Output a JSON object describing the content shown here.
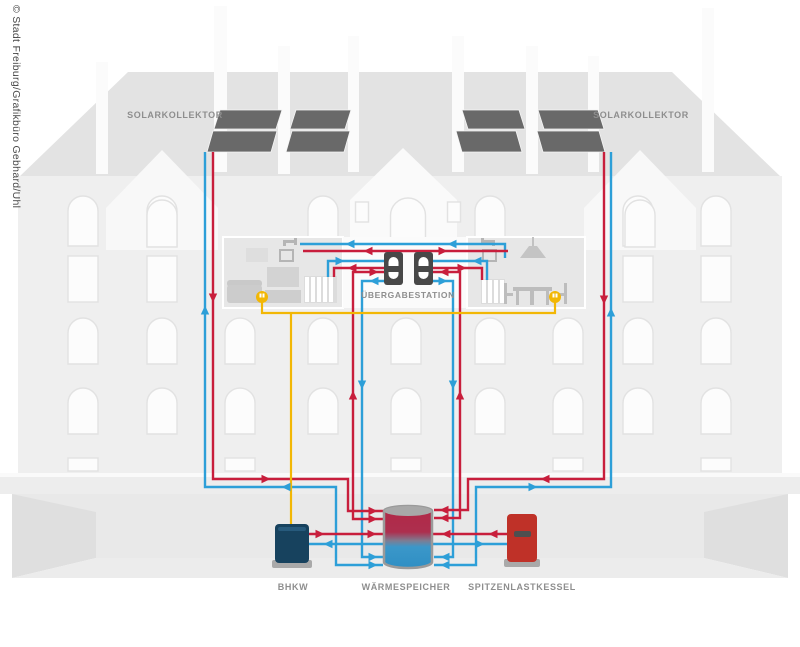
{
  "credit": "© Stadt Freiburg/Grafikbüro Gebhard/Uhl",
  "diagram": {
    "solar_collector_left": "SOLARKOLLEKTOR",
    "solar_collector_right": "SOLARKOLLEKTOR",
    "transfer_station": "ÜBERGABESTATION",
    "chp_unit": "BHKW",
    "heat_storage": "WÄRMESPEICHER",
    "peak_load_boiler": "SPITZENLASTKESSEL"
  },
  "colors": {
    "hot_pipe": "#c81e3c",
    "cold_pipe": "#2d9fd8",
    "power_line": "#f2b705",
    "solar_panel": "#696969",
    "chp_body": "#17425e",
    "boiler_body": "#bf3128",
    "storage_hot": "#b22746",
    "storage_cold": "#2f8fc4"
  }
}
